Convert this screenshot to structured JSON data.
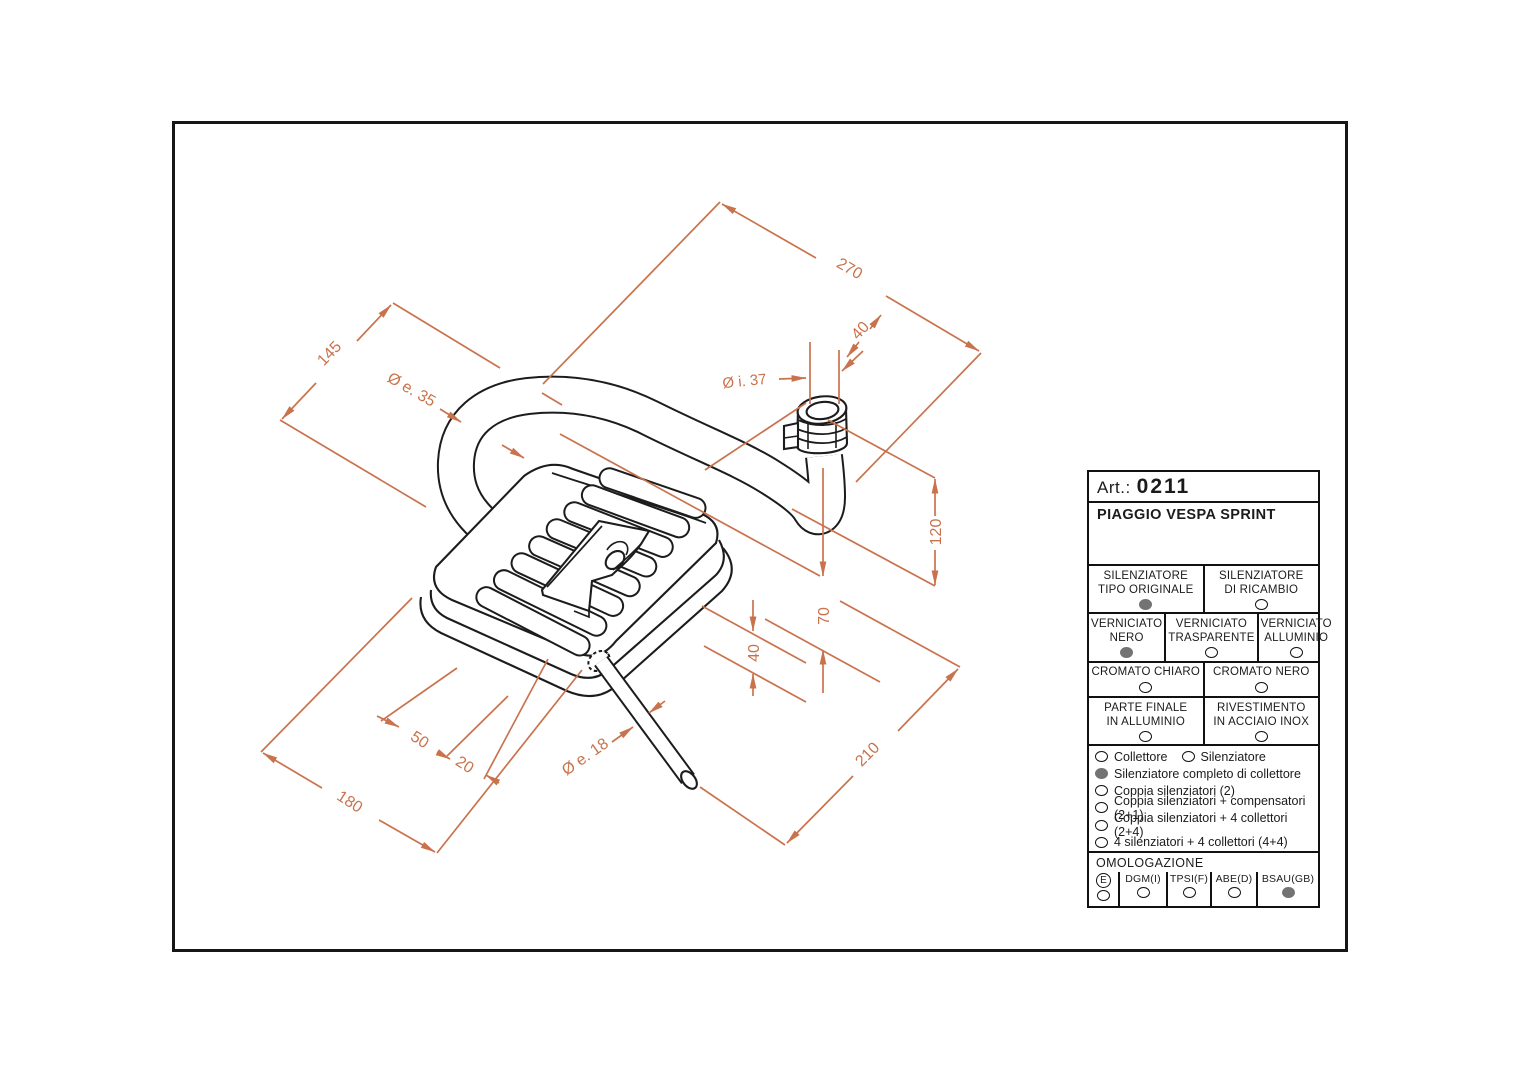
{
  "panel": {
    "art_label": "Art.:",
    "art_number": "0211",
    "model": "PIAGGIO VESPA SPRINT",
    "grid_rows": [
      {
        "cells": [
          {
            "l1": "SILENZIATORE",
            "l2": "TIPO ORIGINALE",
            "state": "filled"
          },
          {
            "l1": "SILENZIATORE",
            "l2": "DI RICAMBIO",
            "state": "empty"
          }
        ]
      },
      {
        "cells": [
          {
            "l1": "VERNICIATO",
            "l2": "NERO",
            "state": "filled"
          },
          {
            "l1": "VERNICIATO",
            "l2": "TRASPARENTE",
            "state": "empty"
          },
          {
            "l1": "VERNICIATO",
            "l2": "ALLUMINIO",
            "state": "empty"
          }
        ]
      },
      {
        "cells": [
          {
            "l1": "CROMATO CHIARO",
            "state": "empty"
          },
          {
            "l1": "CROMATO NERO",
            "state": "empty"
          }
        ]
      },
      {
        "cells": [
          {
            "l1": "PARTE FINALE",
            "l2": "IN ALLUMINIO",
            "state": "empty"
          },
          {
            "l1": "RIVESTIMENTO",
            "l2": "IN ACCIAIO INOX",
            "state": "empty"
          }
        ]
      }
    ],
    "options": [
      {
        "label": "Collettore",
        "state": "empty"
      },
      {
        "label": "Silenziatore",
        "state": "empty"
      },
      {
        "label": "Silenziatore completo di collettore",
        "state": "filled"
      },
      {
        "label": "Coppia silenziatori (2)",
        "state": "empty"
      },
      {
        "label": "Coppia silenziatori + compensatori (2+1)",
        "state": "empty"
      },
      {
        "label": "Coppia silenziatori + 4 collettori (2+4)",
        "state": "empty"
      },
      {
        "label": "4 silenziatori + 4 collettori (4+4)",
        "state": "empty"
      }
    ],
    "omologazione": {
      "title": "OMOLOGAZIONE",
      "entries": [
        {
          "label": "E",
          "state": "empty"
        },
        {
          "label": "DGM(I)",
          "state": "empty"
        },
        {
          "label": "TPSI(F)",
          "state": "empty"
        },
        {
          "label": "ABE(D)",
          "state": "empty"
        },
        {
          "label": "BSAU(GB)",
          "state": "filled"
        }
      ]
    }
  },
  "dimensions": {
    "d270": "270",
    "d40_top": "40",
    "di37": "Ø i. 37",
    "d145": "145",
    "de35": "Ø e. 35",
    "d120": "120",
    "d70": "70",
    "d40_bottom": "40",
    "d210": "210",
    "d50": "50",
    "d20": "20",
    "d180": "180",
    "de18": "Ø e. 18"
  },
  "colors": {
    "dimension_orange": "#c9734d",
    "line_black": "#1c1c1c",
    "radio_filled_gray": "#737373"
  }
}
